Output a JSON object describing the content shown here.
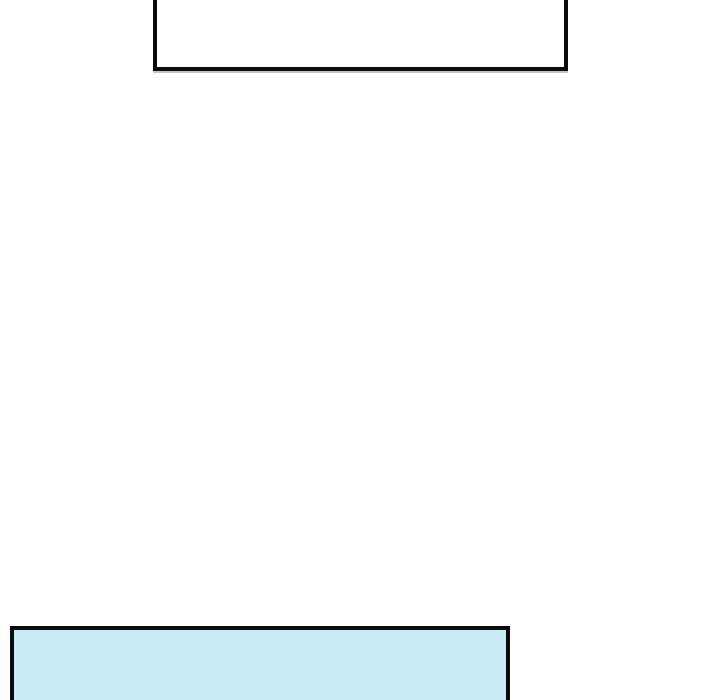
{
  "canvas": {
    "background": "#ffffff"
  },
  "panels": {
    "top": {
      "fill": "#ffffff",
      "border_color": "#0b0b0b"
    },
    "bottom": {
      "fill": "#c6edf3",
      "border_color": "#0b0b0b"
    }
  }
}
